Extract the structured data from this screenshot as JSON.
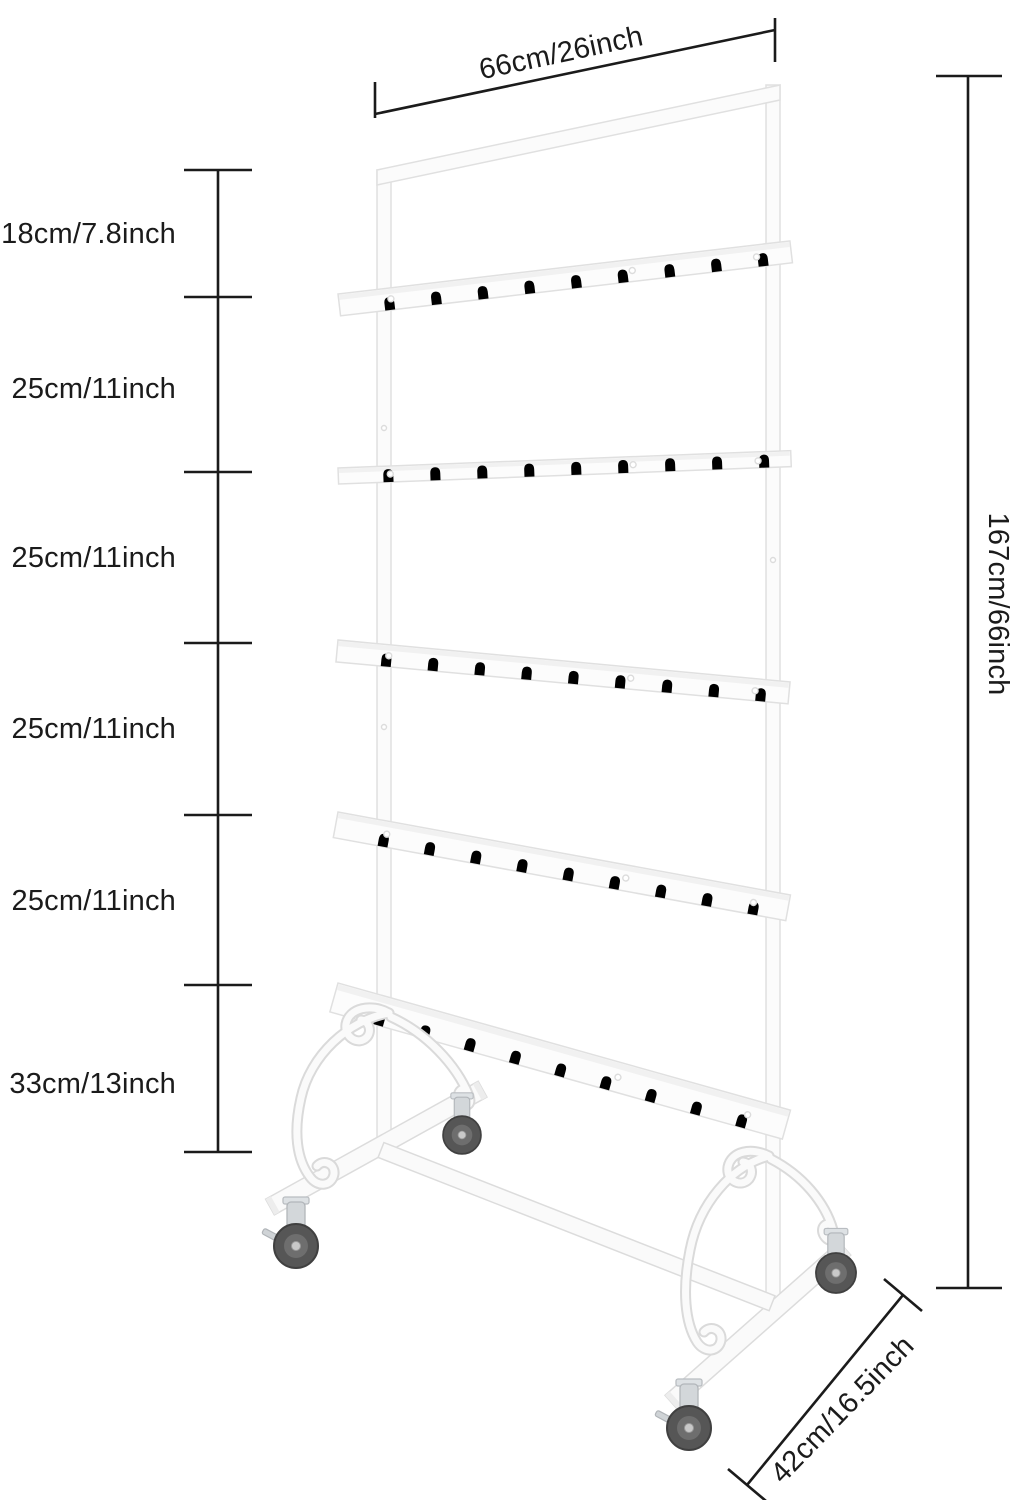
{
  "diagram": {
    "subject": "white rolling display rack with five hook shelves, scroll ornament feet and four casters"
  },
  "dimensions": {
    "width_label": "66cm/26inch",
    "height_label": "167cm/66inch",
    "depth_label": "42cm/16.5inch",
    "left_segment_labels": [
      "18cm/7.8inch",
      "25cm/11inch",
      "25cm/11inch",
      "25cm/11inch",
      "25cm/11inch",
      "33cm/13inch"
    ]
  },
  "colors": {
    "background": "#ffffff",
    "dimension_line": "#1b1b1b",
    "label_text": "#1b1b1b",
    "rack_fill": "#fcfcfc",
    "rack_outline": "#e1e1e1",
    "caster_wheel": "#565656",
    "caster_fork": "#d3d7da"
  }
}
